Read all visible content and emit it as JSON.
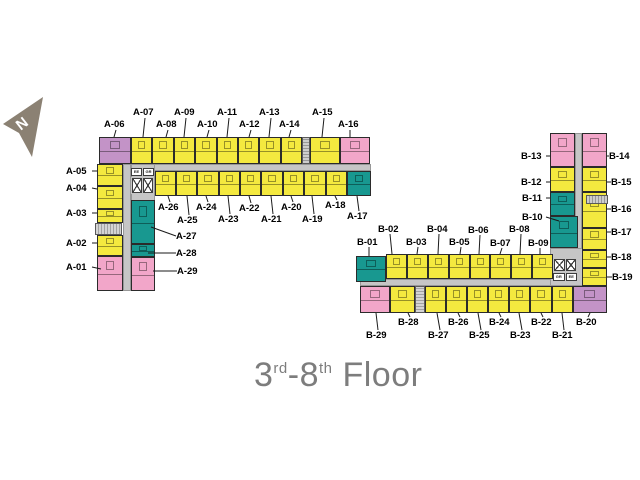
{
  "title": {
    "p1": "3",
    "s1": "rd",
    "p2": "-8",
    "s2": "th",
    "p3": " Floor"
  },
  "compass": {
    "label": "N"
  },
  "colors": {
    "yellow": "#f4e93f",
    "pink": "#f2a6c9",
    "purple": "#c393c7",
    "teal": "#189890",
    "corridor": "#c6c6c6",
    "compass_fill": "#8b8173",
    "title_text": "#7d7d7d",
    "label_text": "#000000"
  },
  "floorplan": {
    "corridors": [
      {
        "x": 123,
        "y": 164,
        "w": 248,
        "h": 7
      },
      {
        "x": 123,
        "y": 164,
        "w": 8,
        "h": 127
      },
      {
        "x": 131,
        "y": 164,
        "w": 24,
        "h": 38
      },
      {
        "x": 360,
        "y": 279,
        "w": 223,
        "h": 7
      },
      {
        "x": 575,
        "y": 133,
        "w": 7,
        "h": 153
      },
      {
        "x": 550,
        "y": 248,
        "w": 33,
        "h": 38
      }
    ],
    "units": [
      {
        "id": "A-06",
        "c": "purple",
        "x": 99,
        "y": 137,
        "w": 32,
        "h": 27
      },
      {
        "id": "A-07",
        "c": "yellow",
        "x": 131,
        "y": 137,
        "w": 21,
        "h": 27
      },
      {
        "id": "A-08",
        "c": "yellow",
        "x": 152,
        "y": 137,
        "w": 22,
        "h": 27
      },
      {
        "id": "A-09",
        "c": "yellow",
        "x": 174,
        "y": 137,
        "w": 21,
        "h": 27
      },
      {
        "id": "A-10",
        "c": "yellow",
        "x": 195,
        "y": 137,
        "w": 22,
        "h": 27
      },
      {
        "id": "A-11",
        "c": "yellow",
        "x": 217,
        "y": 137,
        "w": 21,
        "h": 27
      },
      {
        "id": "A-12",
        "c": "yellow",
        "x": 238,
        "y": 137,
        "w": 21,
        "h": 27
      },
      {
        "id": "A-13",
        "c": "yellow",
        "x": 259,
        "y": 137,
        "w": 22,
        "h": 27
      },
      {
        "id": "A-14",
        "c": "yellow",
        "x": 281,
        "y": 137,
        "w": 21,
        "h": 27
      },
      {
        "id": "A-15",
        "c": "yellow",
        "x": 310,
        "y": 137,
        "w": 30,
        "h": 27
      },
      {
        "id": "A-16",
        "c": "pink",
        "x": 340,
        "y": 137,
        "w": 30,
        "h": 27
      },
      {
        "id": "A-26",
        "c": "yellow",
        "x": 155,
        "y": 171,
        "w": 21,
        "h": 25
      },
      {
        "id": "A-25",
        "c": "yellow",
        "x": 176,
        "y": 171,
        "w": 21,
        "h": 25
      },
      {
        "id": "A-24",
        "c": "yellow",
        "x": 197,
        "y": 171,
        "w": 22,
        "h": 25
      },
      {
        "id": "A-23",
        "c": "yellow",
        "x": 219,
        "y": 171,
        "w": 21,
        "h": 25
      },
      {
        "id": "A-22",
        "c": "yellow",
        "x": 240,
        "y": 171,
        "w": 21,
        "h": 25
      },
      {
        "id": "A-21",
        "c": "yellow",
        "x": 261,
        "y": 171,
        "w": 22,
        "h": 25
      },
      {
        "id": "A-20",
        "c": "yellow",
        "x": 283,
        "y": 171,
        "w": 21,
        "h": 25
      },
      {
        "id": "A-19",
        "c": "yellow",
        "x": 304,
        "y": 171,
        "w": 22,
        "h": 25
      },
      {
        "id": "A-18",
        "c": "yellow",
        "x": 326,
        "y": 171,
        "w": 21,
        "h": 25
      },
      {
        "id": "A-17",
        "c": "teal",
        "x": 347,
        "y": 171,
        "w": 24,
        "h": 25
      },
      {
        "id": "A-05",
        "c": "yellow",
        "x": 97,
        "y": 164,
        "w": 26,
        "h": 22
      },
      {
        "id": "A-04",
        "c": "yellow",
        "x": 97,
        "y": 186,
        "w": 26,
        "h": 23
      },
      {
        "id": "A-03",
        "c": "yellow",
        "x": 97,
        "y": 209,
        "w": 26,
        "h": 14
      },
      {
        "id": "A-02",
        "c": "yellow",
        "x": 97,
        "y": 235,
        "w": 26,
        "h": 21
      },
      {
        "id": "A-01",
        "c": "pink",
        "x": 97,
        "y": 256,
        "w": 26,
        "h": 35
      },
      {
        "id": "A-27",
        "c": "teal",
        "x": 131,
        "y": 200,
        "w": 24,
        "h": 44
      },
      {
        "id": "A-28",
        "c": "teal",
        "x": 131,
        "y": 244,
        "w": 24,
        "h": 13
      },
      {
        "id": "A-29",
        "c": "pink",
        "x": 131,
        "y": 257,
        "w": 24,
        "h": 34
      },
      {
        "id": "B-13",
        "c": "pink",
        "x": 550,
        "y": 133,
        "w": 25,
        "h": 34
      },
      {
        "id": "B-12",
        "c": "yellow",
        "x": 550,
        "y": 167,
        "w": 25,
        "h": 25
      },
      {
        "id": "B-11",
        "c": "teal",
        "x": 550,
        "y": 192,
        "w": 25,
        "h": 24
      },
      {
        "id": "B-10",
        "c": "teal",
        "x": 550,
        "y": 216,
        "w": 28,
        "h": 32
      },
      {
        "id": "B-14",
        "c": "pink",
        "x": 582,
        "y": 133,
        "w": 25,
        "h": 34
      },
      {
        "id": "B-15",
        "c": "yellow",
        "x": 582,
        "y": 167,
        "w": 25,
        "h": 25
      },
      {
        "id": "B-16",
        "c": "yellow",
        "x": 582,
        "y": 192,
        "w": 25,
        "h": 36
      },
      {
        "id": "B-17",
        "c": "yellow",
        "x": 582,
        "y": 228,
        "w": 25,
        "h": 22
      },
      {
        "id": "B-18",
        "c": "yellow",
        "x": 582,
        "y": 250,
        "w": 25,
        "h": 18
      },
      {
        "id": "B-19",
        "c": "yellow",
        "x": 582,
        "y": 268,
        "w": 25,
        "h": 18
      },
      {
        "id": "B-01",
        "c": "teal",
        "x": 356,
        "y": 256,
        "w": 30,
        "h": 26
      },
      {
        "id": "B-02",
        "c": "yellow",
        "x": 386,
        "y": 254,
        "w": 21,
        "h": 25
      },
      {
        "id": "B-03",
        "c": "yellow",
        "x": 407,
        "y": 254,
        "w": 21,
        "h": 25
      },
      {
        "id": "B-04",
        "c": "yellow",
        "x": 428,
        "y": 254,
        "w": 21,
        "h": 25
      },
      {
        "id": "B-05",
        "c": "yellow",
        "x": 449,
        "y": 254,
        "w": 21,
        "h": 25
      },
      {
        "id": "B-06",
        "c": "yellow",
        "x": 470,
        "y": 254,
        "w": 20,
        "h": 25
      },
      {
        "id": "B-07",
        "c": "yellow",
        "x": 490,
        "y": 254,
        "w": 21,
        "h": 25
      },
      {
        "id": "B-08",
        "c": "yellow",
        "x": 511,
        "y": 254,
        "w": 21,
        "h": 25
      },
      {
        "id": "B-09",
        "c": "yellow",
        "x": 532,
        "y": 254,
        "w": 21,
        "h": 25
      },
      {
        "id": "B-29",
        "c": "pink",
        "x": 360,
        "y": 286,
        "w": 30,
        "h": 27
      },
      {
        "id": "B-28",
        "c": "yellow",
        "x": 390,
        "y": 286,
        "w": 25,
        "h": 27
      },
      {
        "id": "B-27",
        "c": "yellow",
        "x": 425,
        "y": 286,
        "w": 21,
        "h": 27
      },
      {
        "id": "B-26",
        "c": "yellow",
        "x": 446,
        "y": 286,
        "w": 21,
        "h": 27
      },
      {
        "id": "B-25",
        "c": "yellow",
        "x": 467,
        "y": 286,
        "w": 21,
        "h": 27
      },
      {
        "id": "B-24",
        "c": "yellow",
        "x": 488,
        "y": 286,
        "w": 21,
        "h": 27
      },
      {
        "id": "B-23",
        "c": "yellow",
        "x": 509,
        "y": 286,
        "w": 21,
        "h": 27
      },
      {
        "id": "B-22",
        "c": "yellow",
        "x": 530,
        "y": 286,
        "w": 22,
        "h": 27
      },
      {
        "id": "B-21",
        "c": "yellow",
        "x": 552,
        "y": 286,
        "w": 21,
        "h": 27
      },
      {
        "id": "B-20",
        "c": "purple",
        "x": 573,
        "y": 286,
        "w": 34,
        "h": 27
      }
    ],
    "service": [
      {
        "kind": "vent-v",
        "x": 302,
        "y": 137,
        "w": 8,
        "h": 27
      },
      {
        "kind": "stairs-h",
        "x": 95,
        "y": 223,
        "w": 27,
        "h": 12
      },
      {
        "kind": "vent-h",
        "x": 586,
        "y": 195,
        "w": 22,
        "h": 9
      },
      {
        "kind": "stairs-v",
        "x": 415,
        "y": 286,
        "w": 10,
        "h": 27
      }
    ],
    "lifts": [
      {
        "x": 131,
        "y": 177,
        "w": 23,
        "h": 17,
        "tags": [
          "EE",
          "GR"
        ],
        "tagPos": "top"
      },
      {
        "x": 553,
        "y": 258,
        "w": 24,
        "h": 14,
        "tags": [
          "GR",
          "EE"
        ],
        "tagPos": "bottom"
      }
    ],
    "labels": [
      {
        "text": "A-07",
        "x": 133,
        "y": 107,
        "line": [
          145,
          118,
          143,
          137
        ]
      },
      {
        "text": "A-09",
        "x": 174,
        "y": 107,
        "line": [
          186,
          118,
          184,
          137
        ]
      },
      {
        "text": "A-11",
        "x": 217,
        "y": 107,
        "line": [
          229,
          118,
          227,
          137
        ]
      },
      {
        "text": "A-13",
        "x": 259,
        "y": 107,
        "line": [
          271,
          118,
          269,
          137
        ]
      },
      {
        "text": "A-15",
        "x": 312,
        "y": 107,
        "line": [
          324,
          118,
          322,
          137
        ]
      },
      {
        "text": "A-06",
        "x": 104,
        "y": 119,
        "line": [
          116,
          130,
          114,
          137
        ]
      },
      {
        "text": "A-08",
        "x": 156,
        "y": 119,
        "line": [
          168,
          130,
          166,
          137
        ]
      },
      {
        "text": "A-10",
        "x": 197,
        "y": 119,
        "line": [
          209,
          130,
          207,
          137
        ]
      },
      {
        "text": "A-12",
        "x": 239,
        "y": 119,
        "line": [
          251,
          130,
          249,
          137
        ]
      },
      {
        "text": "A-14",
        "x": 279,
        "y": 119,
        "line": [
          291,
          130,
          289,
          137
        ]
      },
      {
        "text": "A-16",
        "x": 338,
        "y": 119,
        "line": [
          350,
          130,
          350,
          137
        ]
      },
      {
        "text": "A-05",
        "x": 66,
        "y": 166,
        "line": [
          92,
          171,
          97,
          171
        ]
      },
      {
        "text": "A-04",
        "x": 66,
        "y": 183,
        "line": [
          92,
          188,
          97,
          189
        ]
      },
      {
        "text": "A-03",
        "x": 66,
        "y": 208,
        "line": [
          92,
          213,
          97,
          213
        ]
      },
      {
        "text": "A-02",
        "x": 66,
        "y": 238,
        "line": [
          92,
          243,
          97,
          243
        ]
      },
      {
        "text": "A-01",
        "x": 66,
        "y": 262,
        "line": [
          92,
          267,
          101,
          269
        ]
      },
      {
        "text": "A-26",
        "x": 158,
        "y": 202,
        "line": [
          170,
          202,
          168,
          196
        ]
      },
      {
        "text": "A-24",
        "x": 196,
        "y": 202,
        "line": [
          208,
          202,
          206,
          196
        ]
      },
      {
        "text": "A-22",
        "x": 239,
        "y": 203,
        "line": [
          251,
          203,
          249,
          196
        ]
      },
      {
        "text": "A-20",
        "x": 281,
        "y": 202,
        "line": [
          293,
          202,
          291,
          196
        ]
      },
      {
        "text": "A-18",
        "x": 325,
        "y": 200,
        "line": [
          337,
          200,
          335,
          196
        ]
      },
      {
        "text": "A-25",
        "x": 177,
        "y": 215,
        "line": [
          189,
          215,
          187,
          196
        ]
      },
      {
        "text": "A-23",
        "x": 218,
        "y": 214,
        "line": [
          230,
          214,
          228,
          196
        ]
      },
      {
        "text": "A-21",
        "x": 261,
        "y": 214,
        "line": [
          273,
          214,
          271,
          196
        ]
      },
      {
        "text": "A-19",
        "x": 302,
        "y": 214,
        "line": [
          314,
          214,
          312,
          196
        ]
      },
      {
        "text": "A-17",
        "x": 347,
        "y": 211,
        "line": [
          359,
          211,
          357,
          196
        ]
      },
      {
        "text": "A-27",
        "x": 176,
        "y": 231,
        "line": [
          176,
          236,
          151,
          227
        ]
      },
      {
        "text": "A-28",
        "x": 176,
        "y": 248,
        "line": [
          176,
          253,
          148,
          253
        ]
      },
      {
        "text": "A-29",
        "x": 177,
        "y": 266,
        "line": [
          177,
          271,
          153,
          271
        ]
      },
      {
        "text": "B-02",
        "x": 378,
        "y": 224,
        "line": [
          390,
          234,
          392,
          254
        ]
      },
      {
        "text": "B-04",
        "x": 427,
        "y": 224,
        "line": [
          439,
          234,
          438,
          254
        ]
      },
      {
        "text": "B-06",
        "x": 468,
        "y": 225,
        "line": [
          480,
          235,
          479,
          254
        ]
      },
      {
        "text": "B-08",
        "x": 509,
        "y": 224,
        "line": [
          521,
          234,
          520,
          254
        ]
      },
      {
        "text": "B-01",
        "x": 357,
        "y": 237,
        "line": [
          369,
          247,
          369,
          256
        ]
      },
      {
        "text": "B-03",
        "x": 406,
        "y": 237,
        "line": [
          418,
          247,
          417,
          254
        ]
      },
      {
        "text": "B-05",
        "x": 449,
        "y": 237,
        "line": [
          461,
          247,
          460,
          254
        ]
      },
      {
        "text": "B-07",
        "x": 490,
        "y": 238,
        "line": [
          502,
          248,
          500,
          254
        ]
      },
      {
        "text": "B-09",
        "x": 528,
        "y": 238,
        "line": [
          540,
          248,
          540,
          254
        ]
      },
      {
        "text": "B-13",
        "x": 521,
        "y": 151,
        "line": [
          546,
          156,
          550,
          156
        ]
      },
      {
        "text": "B-12",
        "x": 521,
        "y": 177,
        "line": [
          546,
          182,
          550,
          182
        ]
      },
      {
        "text": "B-11",
        "x": 522,
        "y": 193,
        "line": [
          546,
          198,
          550,
          198
        ]
      },
      {
        "text": "B-10",
        "x": 522,
        "y": 212,
        "line": [
          546,
          217,
          559,
          221
        ]
      },
      {
        "text": "B-14",
        "x": 609,
        "y": 151,
        "line": [
          609,
          156,
          607,
          156
        ]
      },
      {
        "text": "B-15",
        "x": 611,
        "y": 177,
        "line": [
          611,
          182,
          607,
          182
        ]
      },
      {
        "text": "B-16",
        "x": 611,
        "y": 204,
        "line": [
          611,
          209,
          607,
          209
        ]
      },
      {
        "text": "B-17",
        "x": 611,
        "y": 227,
        "line": [
          611,
          232,
          607,
          232
        ]
      },
      {
        "text": "B-18",
        "x": 611,
        "y": 252,
        "line": [
          611,
          257,
          607,
          257
        ]
      },
      {
        "text": "B-19",
        "x": 612,
        "y": 272,
        "line": [
          612,
          277,
          607,
          277
        ]
      },
      {
        "text": "B-28",
        "x": 398,
        "y": 317,
        "line": [
          410,
          317,
          408,
          313
        ]
      },
      {
        "text": "B-26",
        "x": 448,
        "y": 317,
        "line": [
          460,
          317,
          458,
          313
        ]
      },
      {
        "text": "B-24",
        "x": 489,
        "y": 317,
        "line": [
          501,
          317,
          499,
          313
        ]
      },
      {
        "text": "B-22",
        "x": 531,
        "y": 317,
        "line": [
          543,
          317,
          541,
          313
        ]
      },
      {
        "text": "B-20",
        "x": 576,
        "y": 317,
        "line": [
          588,
          317,
          590,
          313
        ]
      },
      {
        "text": "B-29",
        "x": 366,
        "y": 330,
        "line": [
          378,
          330,
          376,
          313
        ]
      },
      {
        "text": "B-27",
        "x": 428,
        "y": 330,
        "line": [
          440,
          330,
          437,
          313
        ]
      },
      {
        "text": "B-25",
        "x": 469,
        "y": 330,
        "line": [
          481,
          330,
          478,
          313
        ]
      },
      {
        "text": "B-23",
        "x": 510,
        "y": 330,
        "line": [
          522,
          330,
          519,
          313
        ]
      },
      {
        "text": "B-21",
        "x": 552,
        "y": 330,
        "line": [
          564,
          330,
          562,
          313
        ]
      }
    ]
  }
}
